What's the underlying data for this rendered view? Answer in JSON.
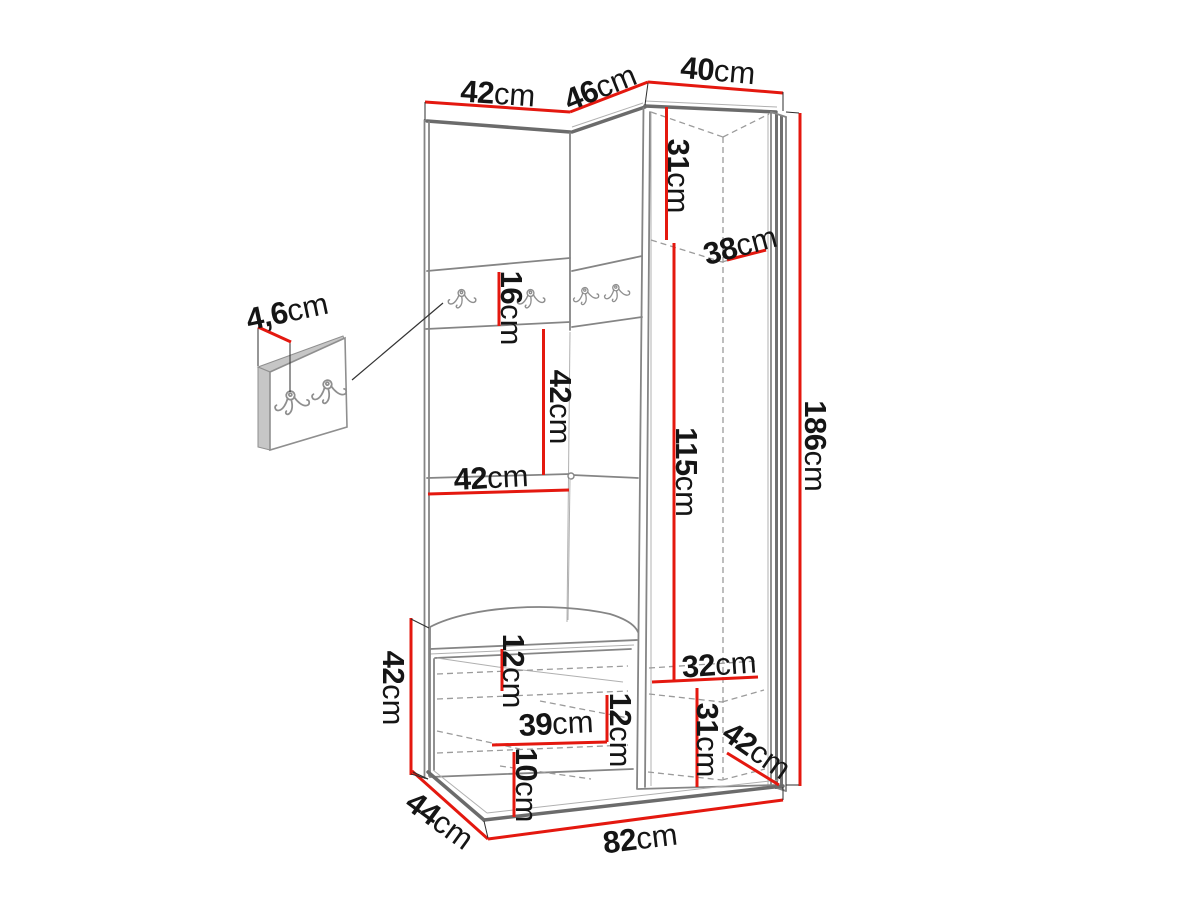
{
  "diagram": {
    "type": "furniture-dimension-drawing",
    "subject": "corner hallway wardrobe set with coat hooks, bench and detached hook panel",
    "unit": "cm"
  },
  "colors": {
    "dimension_line": "#e4180f",
    "outline": "#858585",
    "outline_dark": "#6b6b6b",
    "dashed_interior": "#9b9b9b",
    "label_text": "#151515",
    "background": "#ffffff"
  },
  "dims": {
    "top_width_left": {
      "num": "42",
      "unit": "cm"
    },
    "top_width_mid": {
      "num": "46",
      "unit": "cm"
    },
    "top_width_right": {
      "num": "40",
      "unit": "cm"
    },
    "upper_shelf_height": {
      "num": "31",
      "unit": "cm"
    },
    "upper_shelf_depth": {
      "num": "38",
      "unit": "cm"
    },
    "hook_panel_height": {
      "num": "16",
      "unit": "cm"
    },
    "niche_height": {
      "num": "42",
      "unit": "cm"
    },
    "niche_width": {
      "num": "42",
      "unit": "cm"
    },
    "interior_height": {
      "num": "115",
      "unit": "cm"
    },
    "total_height": {
      "num": "186",
      "unit": "cm"
    },
    "panel_thickness": {
      "num": "4,6",
      "unit": "cm"
    },
    "bench_height": {
      "num": "42",
      "unit": "cm"
    },
    "seat_clearance": {
      "num": "12",
      "unit": "cm"
    },
    "bench_width": {
      "num": "39",
      "unit": "cm"
    },
    "shelf_gap": {
      "num": "12",
      "unit": "cm"
    },
    "bottom_gap": {
      "num": "10",
      "unit": "cm"
    },
    "bottom_shelf_width": {
      "num": "32",
      "unit": "cm"
    },
    "bottom_shelf_height": {
      "num": "31",
      "unit": "cm"
    },
    "side_depth": {
      "num": "42",
      "unit": "cm"
    },
    "bench_depth": {
      "num": "44",
      "unit": "cm"
    },
    "base_width": {
      "num": "82",
      "unit": "cm"
    }
  }
}
